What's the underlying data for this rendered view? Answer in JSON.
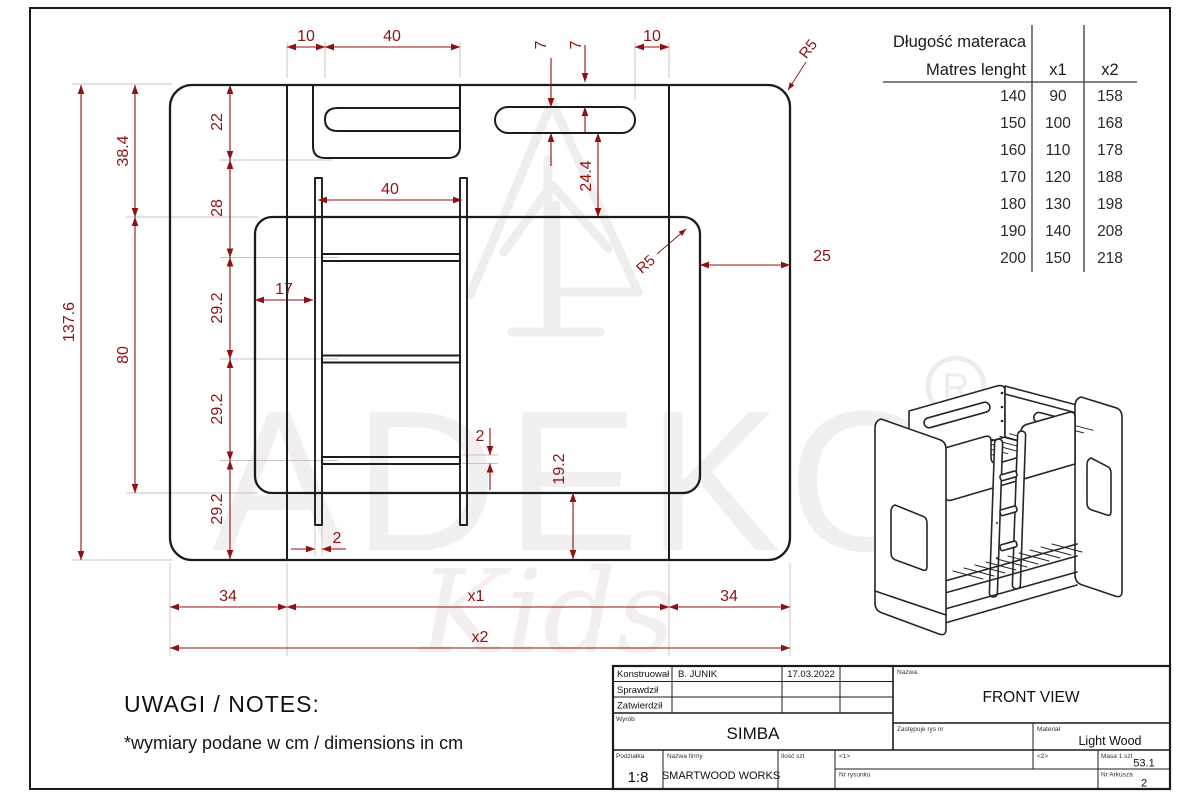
{
  "matress_table": {
    "header_line1": "Długość materaca",
    "header_line2": "Matres lenght",
    "col_x1": "x1",
    "col_x2": "x2",
    "rows": [
      [
        "140",
        "90",
        "158"
      ],
      [
        "150",
        "100",
        "168"
      ],
      [
        "160",
        "110",
        "178"
      ],
      [
        "170",
        "120",
        "188"
      ],
      [
        "180",
        "130",
        "198"
      ],
      [
        "190",
        "140",
        "208"
      ],
      [
        "200",
        "150",
        "218"
      ]
    ]
  },
  "dims": {
    "top_left_offset": "10",
    "top_handle_width": "40",
    "slot_height": "7",
    "slot_top_offset": "7",
    "top_right_offset": "10",
    "outer_corner_radius": "R5",
    "inner_corner_radius": "R5",
    "total_height": "137.6",
    "upper_section_height": "38.4",
    "lower_panel_height": "80",
    "chain": [
      "22",
      "28",
      "29.2",
      "29.2",
      "29.2"
    ],
    "ladder_width": "40",
    "ladder_offset": "17",
    "slot_to_panel": "24.4",
    "right_offset": "25",
    "rung_thickness": "2",
    "stile_thickness": "2",
    "panel_bottom_height": "19.2",
    "bottom_left": "34",
    "bottom_center": "x1",
    "bottom_right": "34",
    "bottom_total": "x2"
  },
  "notes": {
    "heading": "UWAGI / NOTES:",
    "line": "*wymiary podane w cm / dimensions in cm"
  },
  "title_block": {
    "labels": {
      "designed": "Konstruował",
      "checked": "Sprawdził",
      "approved": "Zatwierdził",
      "product": "Wyrób",
      "name": "Nazwa:",
      "replaces": "Zastępuje rys nr",
      "material": "Materiał",
      "scale": "Podziałka",
      "company": "Nazwa firmy",
      "qty": "Ilość szt",
      "f1": "<1>",
      "f2": "<2>",
      "mass": "Masa 1 szt",
      "drawing_no": "Nr rysunku",
      "sheet_no": "Nr Arkusza"
    },
    "values": {
      "designed_by": "B. JUNIK",
      "date": "17.03.2022",
      "product": "SIMBA",
      "view_name": "FRONT VIEW",
      "material": "Light Wood",
      "scale": "1:8",
      "company": "SMARTWOOD WORKS",
      "mass": "53.1",
      "sheet": "2"
    }
  },
  "watermark": {
    "brand": "ADEKO",
    "registered": "R",
    "script": "Kids"
  },
  "colors": {
    "dimension": "#8e1212",
    "drawing_line": "#1c1c1c",
    "extension_line": "#cfc0c0",
    "watermark": "#f1efef"
  }
}
